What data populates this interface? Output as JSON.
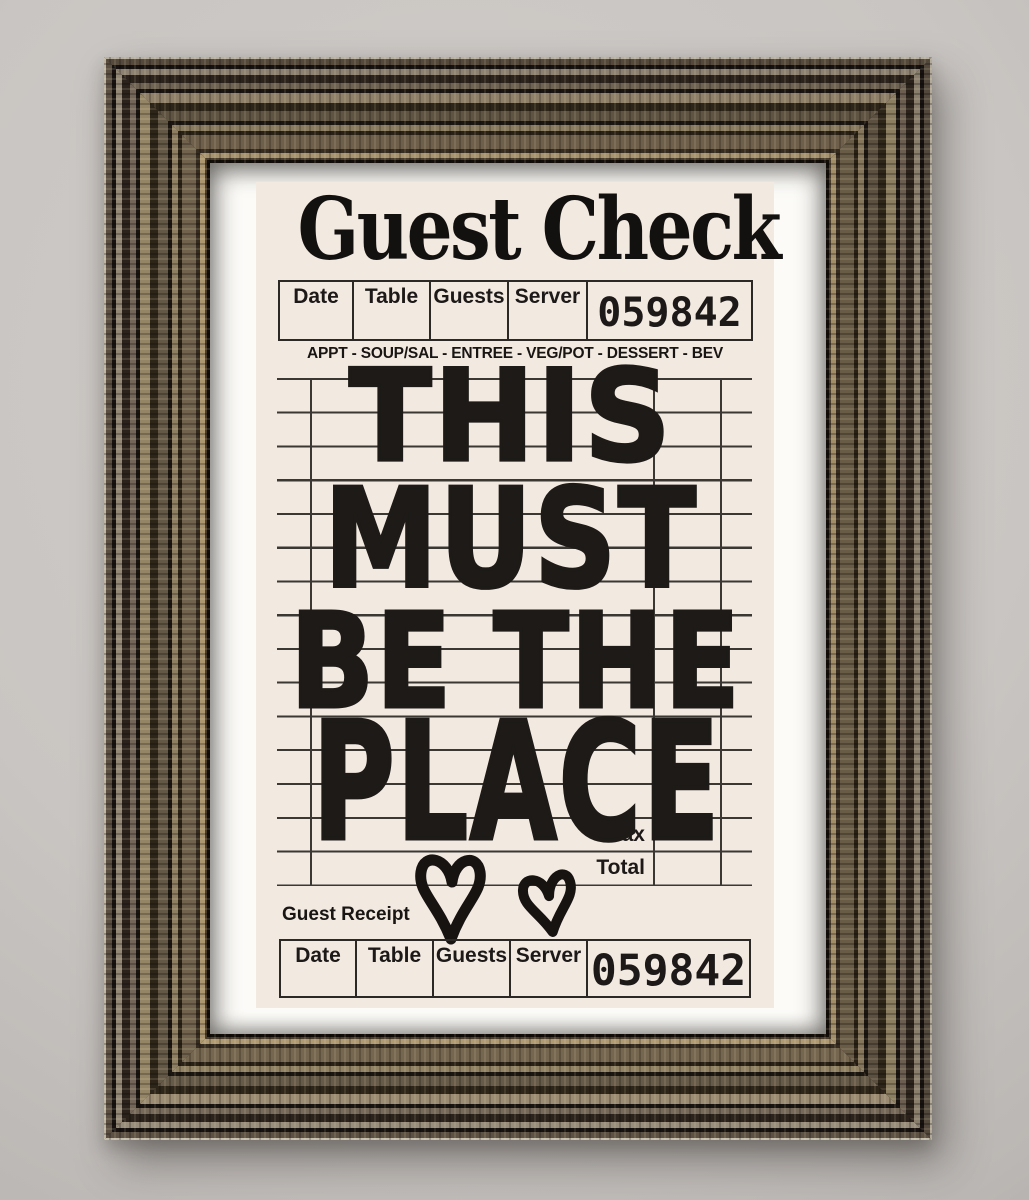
{
  "check": {
    "title": "Guest Check",
    "check_number": "059842",
    "header": {
      "columns": [
        "Date",
        "Table",
        "Guests",
        "Server"
      ]
    },
    "courses_line": "APPT - SOUP/SAL - ENTREE - VEG/POT - DESSERT - BEV",
    "quote": {
      "lines": [
        "THIS",
        "MUST",
        "BE THE",
        "PLACE"
      ]
    },
    "totals": {
      "tax_label": "Tax",
      "total_label": "Total"
    },
    "receipt": {
      "section_label": "Guest Receipt",
      "columns": [
        "Date",
        "Table",
        "Guests",
        "Server"
      ],
      "number": "059842"
    },
    "decorations": {
      "hearts": [
        "heart-icon",
        "heart-icon"
      ]
    },
    "colors": {
      "number_red": "#c2222a",
      "paper_cream": "#f2e9e1",
      "ink_black": "#1d1a17",
      "grid_line": "#3b3733",
      "mat_white": "#fcfbf8",
      "frame_bronze": "#6d5f4a"
    }
  }
}
